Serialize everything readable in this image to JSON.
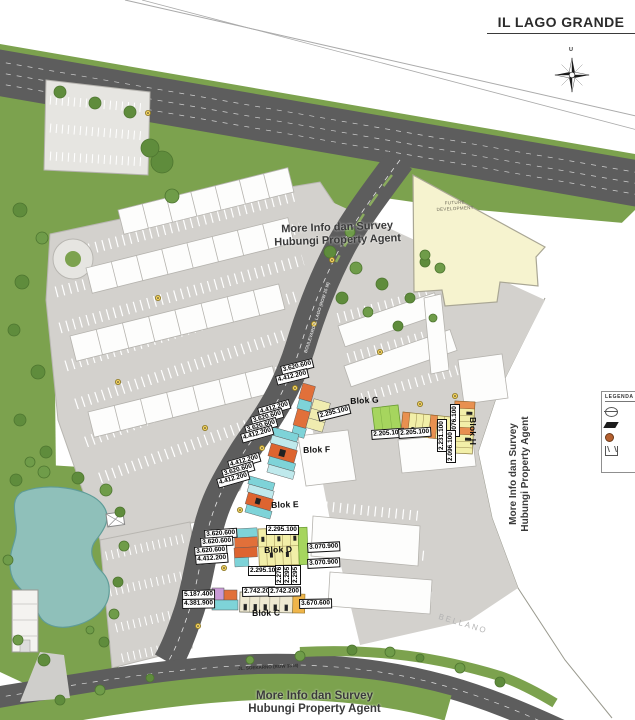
{
  "title": "IL LAGO GRANDE",
  "compass": {
    "north": "U"
  },
  "agent_note": {
    "line1": "More Info dan Survey",
    "line2": "Hubungi Property Agent"
  },
  "areas": {
    "future_development": "FUTURE DEVELOPMENT",
    "neighbor": "BELLANO"
  },
  "roads": {
    "soekarno": "JL. SOEKARNO (ROW 33 M)",
    "boulevard": "BOULEVARD IL LAGO (ROW 25 M)"
  },
  "legend": {
    "title": "LEGENDA",
    "icons": [
      "roundabout-icon",
      "street-icon",
      "lamp-icon",
      "gate-icon"
    ]
  },
  "blocks": {
    "c": "Blok C",
    "d": "Blok D",
    "e": "Blok E",
    "f": "Blok F",
    "g": "Blok G",
    "h": "Blok H"
  },
  "prices": {
    "g_left_1": "3.620.600",
    "g_left_2": "4.412.200",
    "g_mid": "2.295.100",
    "g_row_1": "2.205.100",
    "g_row_2": "2.205.100",
    "g_side": "2.231.100",
    "h_1": "2.076.100",
    "h_2": "2.096.100",
    "f_1": "4.412.200",
    "f_2": "3.620.600",
    "f_3": "3.620.600",
    "f_4": "4.412.200",
    "e_1": "4.412.200",
    "e_2": "3.620.600",
    "e_3": "4.412.200",
    "d_left_1": "3.620.600",
    "d_left_2": "3.620.600",
    "d_left_3": "3.620.600",
    "d_left_4": "4.412.200",
    "d_top": "2.295.100",
    "d_right_1": "3.070.900",
    "d_right_2": "3.070.900",
    "d_bottom": "2.295.100",
    "d_small_1": "2.276",
    "d_small_2": "2.295",
    "d_small_3": "2.295",
    "c_left_1": "5.187.400",
    "c_left_2": "4.381.900",
    "c_top_1": "2.742.200",
    "c_top_2": "2.742.200",
    "c_right": "3.670.600"
  }
}
